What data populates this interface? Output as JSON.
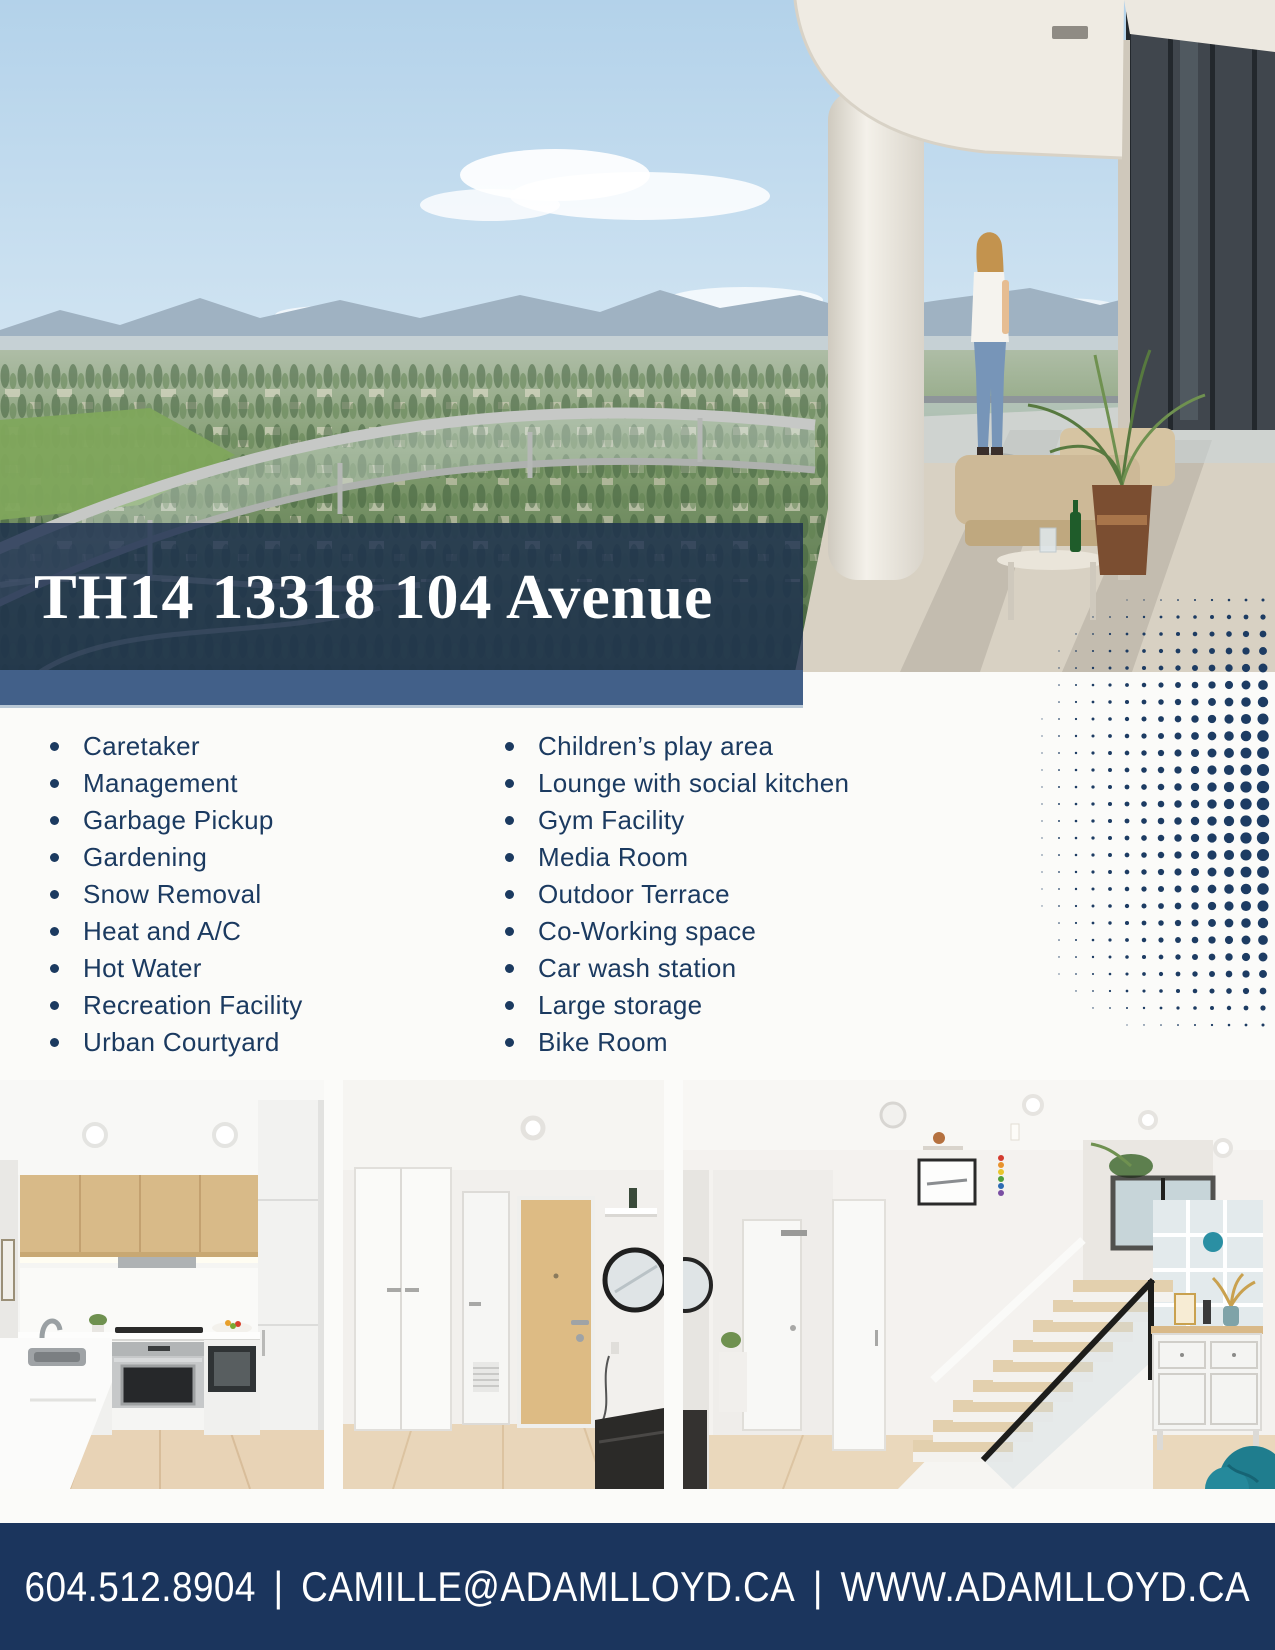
{
  "title": "TH14 13318 104 Avenue",
  "amenities": {
    "left": [
      "Caretaker",
      "Management",
      "Garbage Pickup",
      "Gardening",
      "Snow Removal",
      "Heat and A/C",
      "Hot Water",
      "Recreation Facility",
      "Urban Courtyard"
    ],
    "right": [
      "Children’s play area",
      "Lounge with social kitchen",
      "Gym Facility",
      "Media Room",
      "Outdoor Terrace",
      "Co-Working space",
      "Car wash station",
      "Large storage",
      "Bike Room"
    ]
  },
  "footer": {
    "phone": "604.512.8904",
    "email": "CAMILLE@ADAMLLOYD.CA",
    "website": "WWW.ADAMLLOYD.CA",
    "separator": "|"
  },
  "colors": {
    "navy": "#1b355d",
    "steel_blue": "#426089",
    "overlay_navy": "rgba(26,45,77,0.8)",
    "text_navy": "#1b3a60",
    "dot_navy": "#1d3c63",
    "background": "#fbfbf9",
    "title_white": "#ffffff"
  }
}
